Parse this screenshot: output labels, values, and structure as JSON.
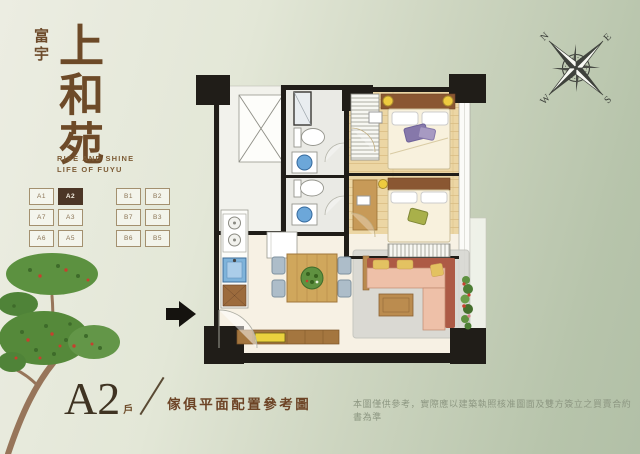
{
  "brand": {
    "company": "富宇",
    "project": "上和苑",
    "tagline1": "RISE AND SHINE",
    "tagline2": "LIFE OF FUYU"
  },
  "unit_selector": {
    "building_a": [
      [
        "A1",
        "A2"
      ],
      [
        "A7",
        "A3"
      ],
      [
        "A6",
        "A5"
      ]
    ],
    "building_b": [
      [
        "B1",
        "B2"
      ],
      [
        "B7",
        "B3"
      ],
      [
        "B6",
        "B5"
      ]
    ],
    "selected": "A2"
  },
  "plan_caption": {
    "unit": "A2",
    "suffix": "戶",
    "caption": "傢俱平面配置參考圖"
  },
  "disclaimer": "本圖僅供參考，實際應以建築執照核准圖面及雙方簽立之買賣合約書為準",
  "compass": {
    "n": "N",
    "e": "E",
    "s": "S",
    "w": "W"
  },
  "colors": {
    "background_sage": "#b7c4ab",
    "background_light": "#ecede2",
    "brand_brown": "#6d4a28",
    "selected_unit_bg": "#4c3626",
    "wall_black": "#201d18",
    "wood_floor": "#ecd6a4",
    "sofa_terracotta": "#ad5a45",
    "water_blue": "#6ca7d9",
    "tree_green": "#55893a",
    "flower_red": "#c6402e"
  }
}
